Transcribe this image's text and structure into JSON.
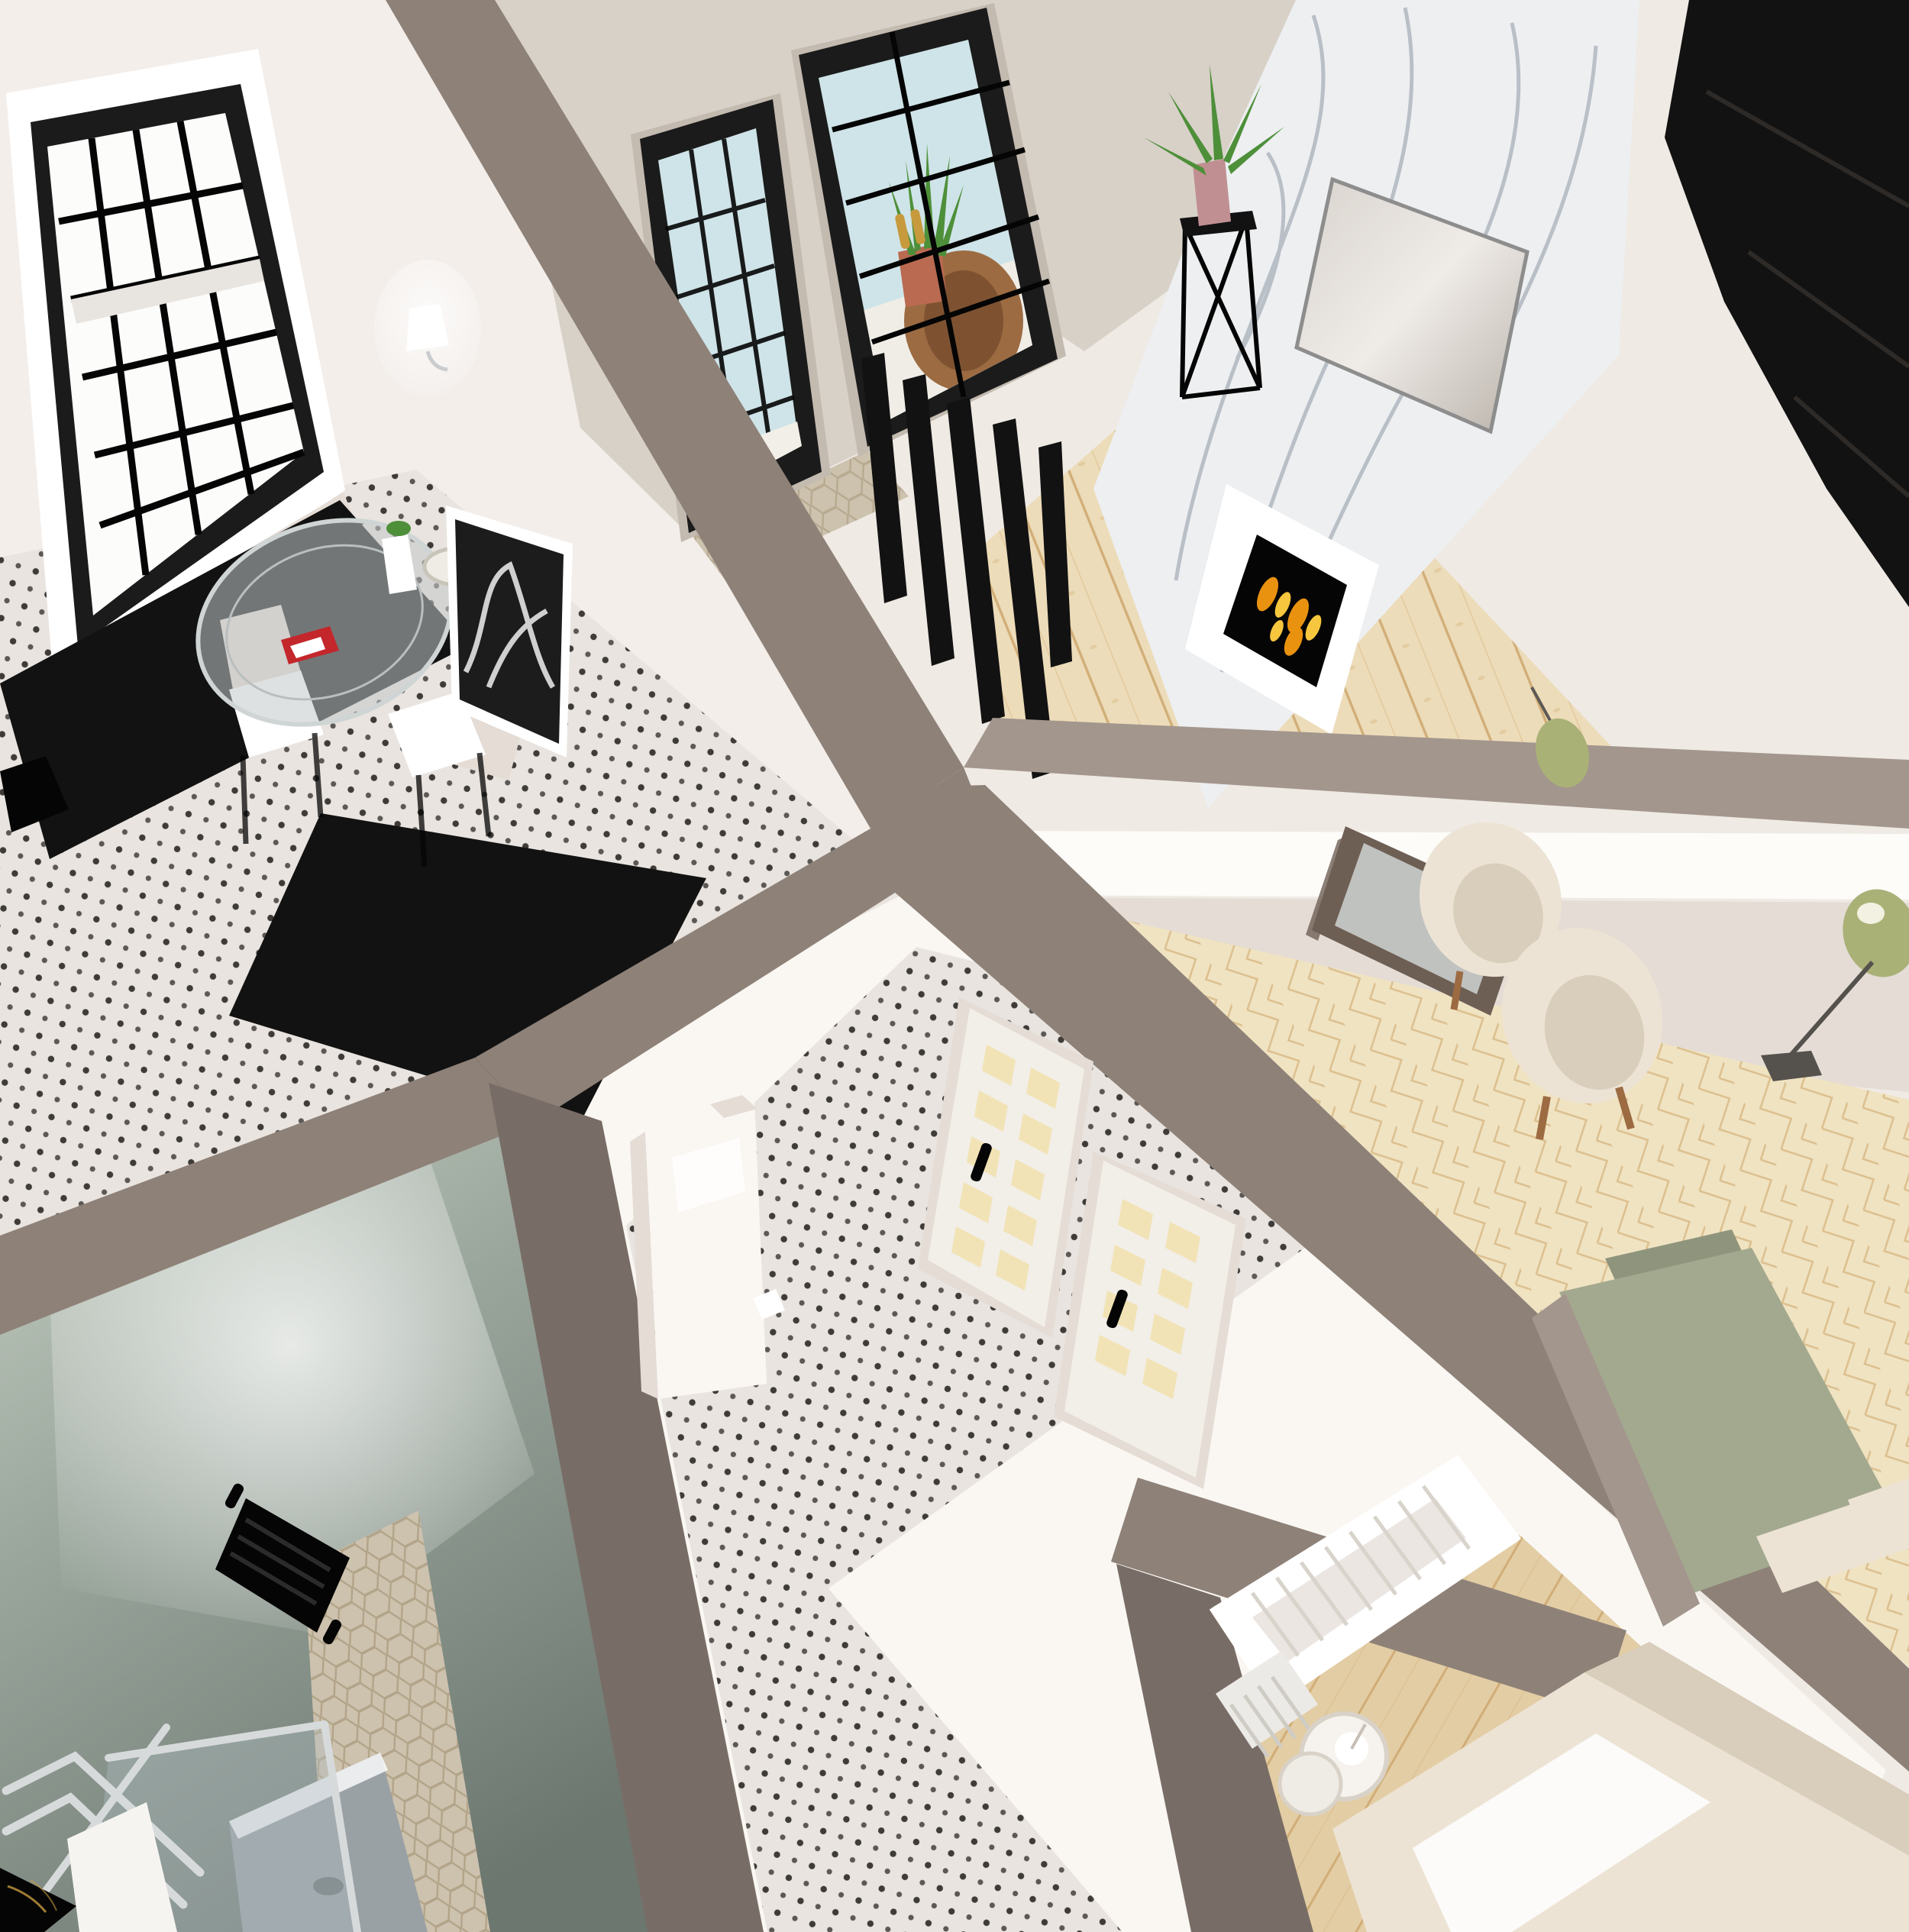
{
  "title": "apartment-3d-floorplan-render",
  "palette": {
    "bg": "#efeae4",
    "faceWhite": "#f3eeea",
    "faceBright": "#faf7f3",
    "faceShade": "#e4dcd5",
    "greige": "#d8d1c8",
    "greigeDark": "#c3bab0",
    "wallTop": "#8e8178",
    "wallTopLight": "#a3968d",
    "wallTopDark": "#786d66",
    "dotBase": "#e9e4df",
    "dotColor": "#201d1b",
    "hexBase": "#cdc2ae",
    "hexLine": "#b2a489",
    "woodBase": "#eddcb9",
    "woodLine": "#c99f63",
    "chevBase": "#f0e3c2",
    "chevLine": "#cfa86e",
    "nurseryWoodBase": "#e3cda4",
    "marble": "#edeff1",
    "marbleVein": "#8f99a4",
    "blackFurniture": "#121212",
    "blackDeep": "#050505",
    "glassBlue": "#cfe4e8",
    "glassFrame": "#1b1b1b",
    "gold": "#c79a3e",
    "plantGreen": "#4e8f3a",
    "terracotta": "#b96a50",
    "rattan": "#9c6b42",
    "sageLamp": "#aab177",
    "sageBed": "#a3a98e",
    "sageBedDark": "#8f957c",
    "mintLight": "#c9d2c6",
    "mintMid": "#9aa69c",
    "mintDark": "#6c7770",
    "cream": "#ece3d4",
    "creamShade": "#d9cdbb",
    "white": "#ffffff",
    "frameBronze": "#6e5f55",
    "silver": "#c9cdcf",
    "silverDark": "#9aa1a5",
    "chrome": "#d7dadb",
    "grayTray": "#9aa1a5",
    "towelWhite": "#f6f4f1",
    "ledWhite": "#fdfcf9",
    "artDark": "#1c1c1c",
    "red": "#c3272c",
    "pink": "#c08f92",
    "flameOrange": "#e8920f",
    "flameYellow": "#f6c63e",
    "glassClear": "rgba(175,190,195,0.38)",
    "tableGlass": "rgba(195,200,200,0.55)"
  },
  "scene": {
    "view": "aerial-cutaway-3d-floor-plan",
    "rooms": [
      {
        "name": "kitchen-dining",
        "objects": [
          "grid-window",
          "wall-sconce",
          "black-counter",
          "glass-round-table",
          "white-chairs",
          "red-magazines",
          "bw-artwork",
          "dot-tile-floor",
          "black-sideboard"
        ]
      },
      {
        "name": "balcony-entry",
        "objects": [
          "black-framed-glass-doors",
          "snake-plant",
          "rattan-chair",
          "black-slat-partition",
          "hex-tile-floor"
        ]
      },
      {
        "name": "living-room",
        "objects": [
          "marble-accent-wall",
          "wall-tv",
          "white-linear-fireplace",
          "black-wardrobe",
          "plant-stand",
          "wood-plank-floor"
        ]
      },
      {
        "name": "bedroom",
        "objects": [
          "led-wall-strip",
          "leaning-mirror",
          "cream-armchairs",
          "sage-floor-lamp",
          "sage-pendant",
          "green-bed",
          "cream-pillows",
          "chevron-wood-floor"
        ]
      },
      {
        "name": "hallway",
        "objects": [
          "white-cabinet",
          "slatted-glass-doors",
          "dot-tile-floor"
        ]
      },
      {
        "name": "nursery",
        "objects": [
          "white-crib",
          "radiator",
          "round-pendant-lamp",
          "cream-bed",
          "wood-plank-floor"
        ]
      },
      {
        "name": "bathroom",
        "objects": [
          "mint-walls",
          "black-towel-radiator",
          "glass-shower",
          "chrome-towel-rail",
          "white-towel",
          "black-marble-vanity",
          "hex-tile-floor",
          "shower-tray"
        ]
      }
    ]
  }
}
